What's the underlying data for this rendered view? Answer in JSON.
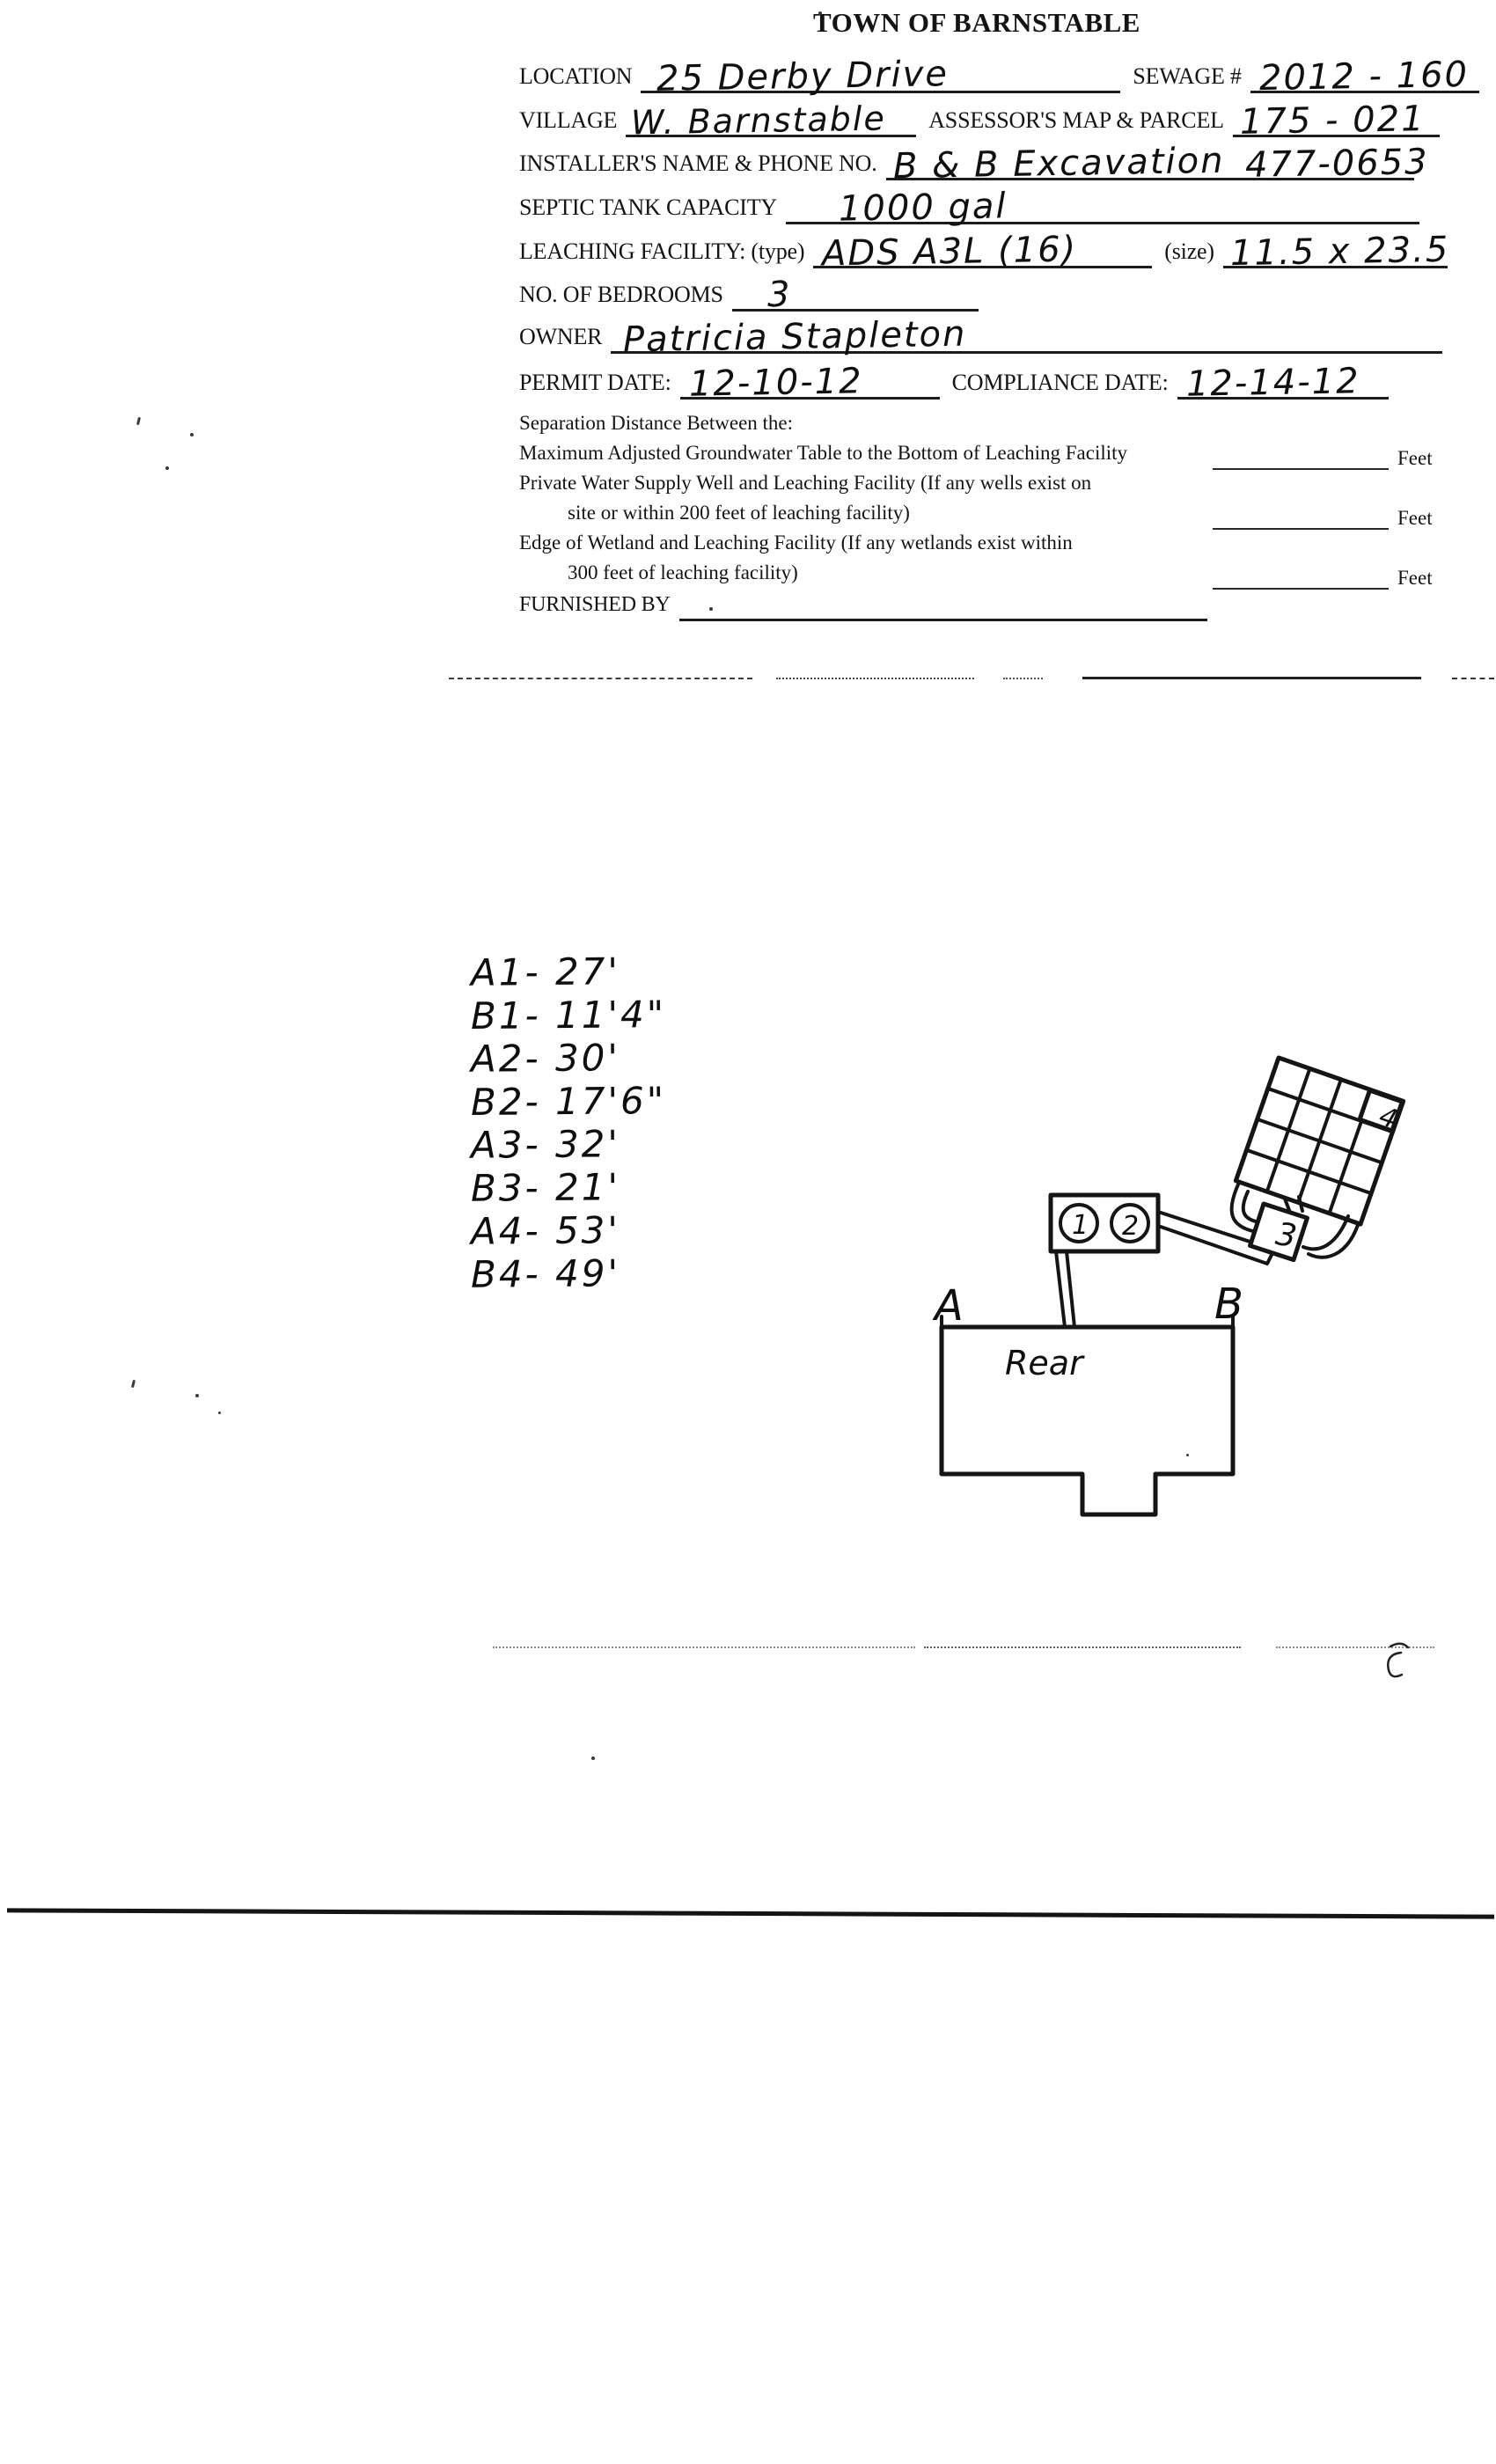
{
  "form": {
    "title": "TOWN OF BARNSTABLE",
    "location": {
      "label": "LOCATION",
      "value": "25 Derby Drive"
    },
    "sewage": {
      "label": "SEWAGE #",
      "value": "2012 - 160"
    },
    "village": {
      "label": "VILLAGE",
      "value": "W. Barnstable"
    },
    "assessors": {
      "label": "ASSESSOR'S MAP & PARCEL",
      "value": "175 - 021"
    },
    "installer": {
      "label": "INSTALLER'S NAME & PHONE NO.",
      "name": "B & B Excavation",
      "phone": "477-0653"
    },
    "septic": {
      "label": "SEPTIC TANK CAPACITY",
      "value": "1000 gal"
    },
    "leaching": {
      "label": "LEACHING FACILITY: (type)",
      "type_value": "ADS A3L (16)",
      "size_label": "(size)",
      "size_value": "11.5 x 23.5"
    },
    "bedrooms": {
      "label": "NO. OF BEDROOMS",
      "value": "3"
    },
    "owner": {
      "label": "OWNER",
      "value": "Patricia Stapleton"
    },
    "permit": {
      "label": "PERMIT DATE:",
      "value": "12-10-12"
    },
    "compliance": {
      "label": "COMPLIANCE DATE:",
      "value": "12-14-12"
    },
    "separation": {
      "heading": "Separation Distance Between the:",
      "line1": "Maximum Adjusted Groundwater Table to the Bottom of Leaching Facility",
      "line2": "Private Water Supply Well and Leaching Facility (If any wells exist on",
      "line3": "site or within 200 feet of leaching facility)",
      "line4": "Edge of Wetland and Leaching Facility (If any wetlands exist within",
      "line5": "300 feet of leaching facility)",
      "feet_label": "Feet"
    },
    "furnished": {
      "label": "FURNISHED BY"
    }
  },
  "measurements": {
    "items": [
      "A1- 27'",
      "B1- 11'4\"",
      "A2- 30'",
      "B2- 17'6\"",
      "A3- 32'",
      "B3- 21'",
      "A4- 53'",
      "B4- 49'"
    ]
  },
  "diagram": {
    "corner_a": "A",
    "corner_b": "B",
    "house_label": "Rear",
    "tank_compartment_1": "1",
    "tank_compartment_2": "2",
    "distribution_box": "3",
    "leach_field": "4"
  }
}
